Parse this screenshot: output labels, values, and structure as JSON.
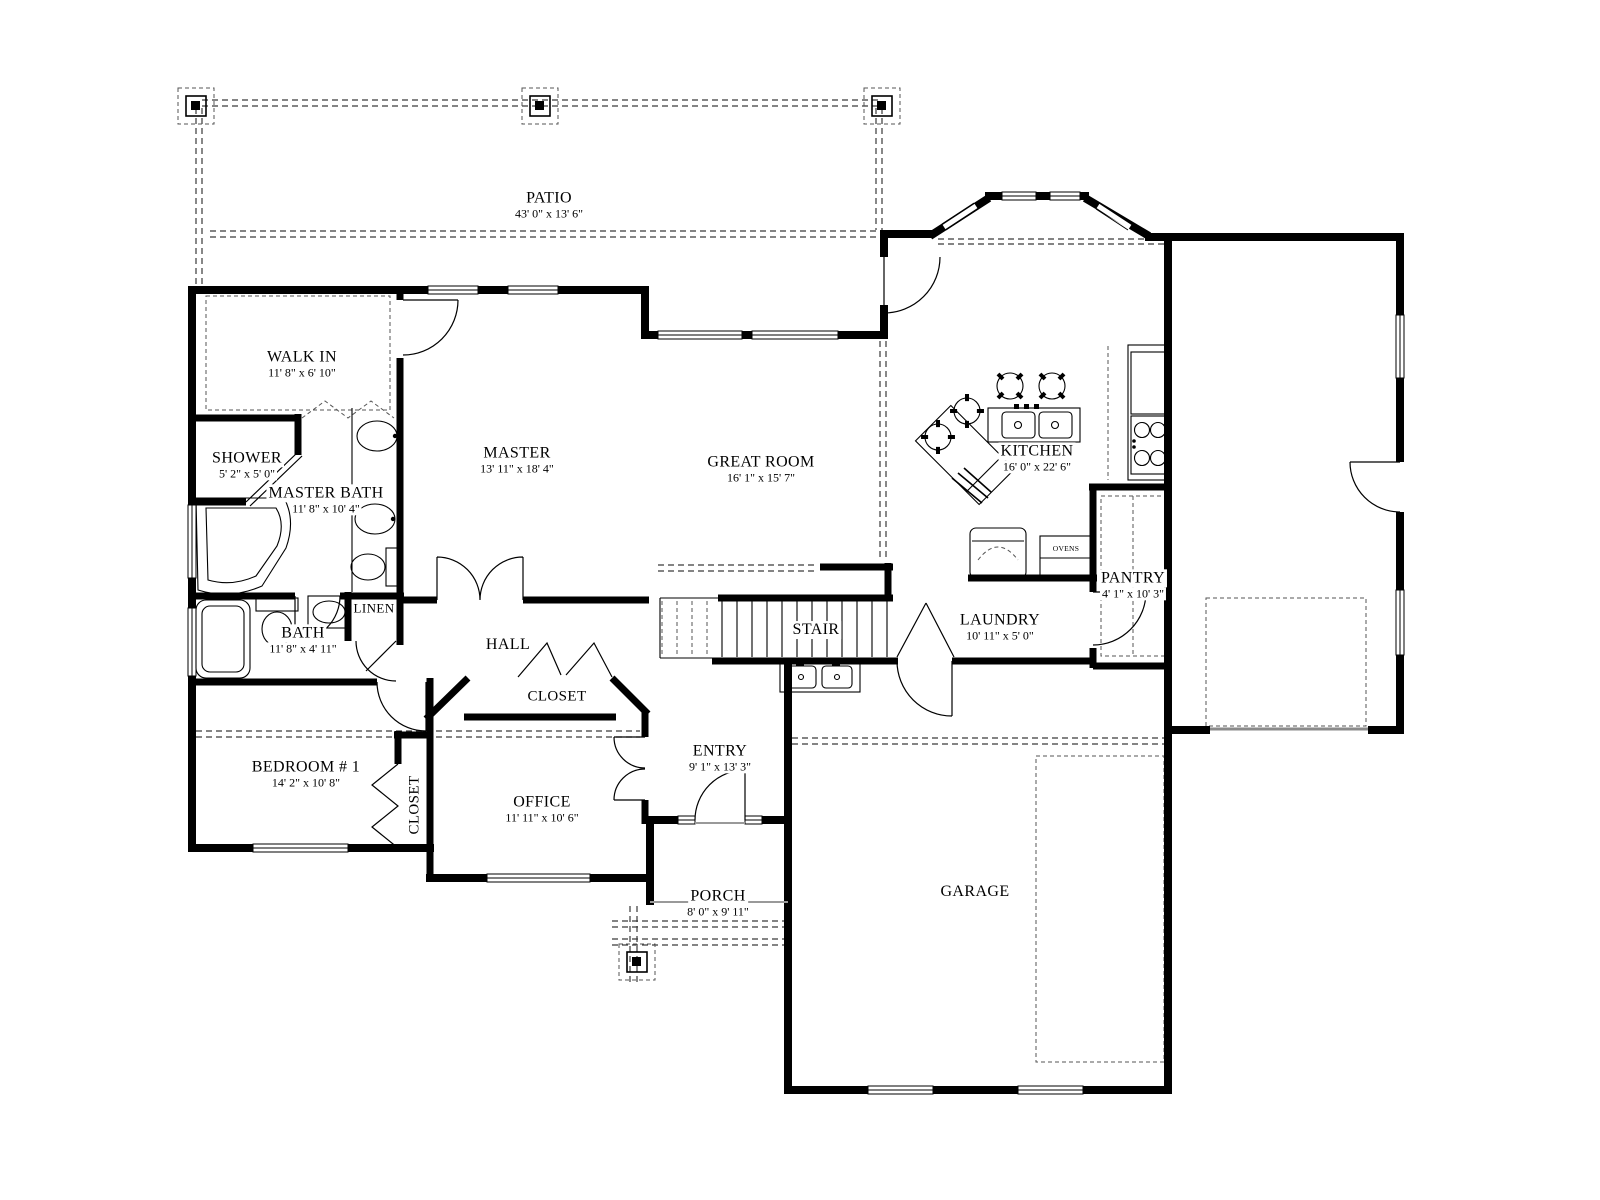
{
  "title": "Floor Plan",
  "colors": {
    "wall": "#000000",
    "background": "#ffffff",
    "dashed_line": "#3a3a3a",
    "opening_gray": "#8a8a8a"
  },
  "rooms": [
    {
      "id": "patio",
      "name": "PATIO",
      "dims": "43' 0\" x 13' 6\""
    },
    {
      "id": "walk-in",
      "name": "WALK IN",
      "dims": "11' 8\" x 6' 10\""
    },
    {
      "id": "shower",
      "name": "SHOWER",
      "dims": "5' 2\" x 5' 0\""
    },
    {
      "id": "master-bath",
      "name": "MASTER BATH",
      "dims": "11' 8\" x 10' 4\""
    },
    {
      "id": "master",
      "name": "MASTER",
      "dims": "13' 11\" x 18' 4\""
    },
    {
      "id": "great-room",
      "name": "GREAT ROOM",
      "dims": "16' 1\" x 15' 7\""
    },
    {
      "id": "kitchen",
      "name": "KITCHEN",
      "dims": "16' 0\" x 22' 6\""
    },
    {
      "id": "pantry",
      "name": "PANTRY",
      "dims": "4' 1\" x 10' 3\""
    },
    {
      "id": "laundry",
      "name": "LAUNDRY",
      "dims": "10' 11\" x 5' 0\""
    },
    {
      "id": "stair",
      "name": "STAIR",
      "dims": ""
    },
    {
      "id": "bath",
      "name": "BATH",
      "dims": "11' 8\" x 4' 11\""
    },
    {
      "id": "linen",
      "name": "LINEN",
      "dims": ""
    },
    {
      "id": "hall",
      "name": "HALL",
      "dims": ""
    },
    {
      "id": "hall-closet",
      "name": "CLOSET",
      "dims": ""
    },
    {
      "id": "bedroom-1",
      "name": "BEDROOM # 1",
      "dims": "14' 2\" x 10' 8\""
    },
    {
      "id": "bedroom-closet",
      "name": "CLOSET",
      "dims": ""
    },
    {
      "id": "office",
      "name": "OFFICE",
      "dims": "11' 11\" x 10' 6\""
    },
    {
      "id": "entry",
      "name": "ENTRY",
      "dims": "9' 1\" x 13' 3\""
    },
    {
      "id": "porch",
      "name": "PORCH",
      "dims": "8' 0\" x 9' 11\""
    },
    {
      "id": "garage",
      "name": "GARAGE",
      "dims": ""
    }
  ],
  "appliances": {
    "ovens_label": "OVENS"
  }
}
